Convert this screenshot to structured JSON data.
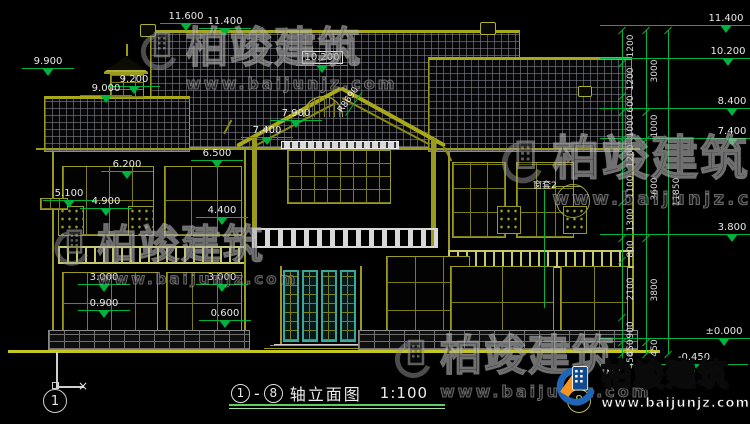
{
  "colors": {
    "line": "#9a9a20",
    "dimension": "#00b33c",
    "text": "#e8e8e8",
    "teal_door": "#3aa79b",
    "ground": "#c6c61e",
    "logo_blue": "#1f66b8",
    "logo_orange": "#f7941d"
  },
  "watermark": {
    "brand": "柏竣建筑",
    "url": "www.baijunjz.com"
  },
  "watermarks": {
    "instances": [
      {
        "x": 132,
        "y": 26,
        "scale": 1.0
      },
      {
        "x": 46,
        "y": 224,
        "scale": 0.95
      },
      {
        "x": 492,
        "y": 134,
        "scale": 1.12
      },
      {
        "x": 386,
        "y": 334,
        "scale": 1.0
      }
    ]
  },
  "logo": {
    "brand": "柏竣建筑",
    "url": "www.baijunjz.com"
  },
  "drawing": {
    "title": {
      "axis_from": "1",
      "dash": "-",
      "axis_to": "8",
      "name": "轴立面图",
      "scale": "1:100"
    },
    "axis_bubbles": [
      {
        "label": "1"
      },
      {
        "label": "8"
      }
    ],
    "ucs_x": "×",
    "slope_label": "R8690",
    "window_callout": "窗套2",
    "px_per_mm": 0.027368,
    "elevation_markers": [
      {
        "v": "9.900",
        "x": 22,
        "y": 56
      },
      {
        "v": "11.600",
        "x": 160,
        "y": 11
      },
      {
        "v": "11.400",
        "x": 199,
        "y": 16
      },
      {
        "v": "9.200",
        "x": 108,
        "y": 74
      },
      {
        "v": "9.000",
        "x": 80,
        "y": 83
      },
      {
        "v": "10.200",
        "x": 296,
        "y": 51,
        "boxed": true
      },
      {
        "v": "7.900",
        "x": 270,
        "y": 108
      },
      {
        "v": "7.400",
        "x": 241,
        "y": 125
      },
      {
        "v": "6.500",
        "x": 191,
        "y": 148
      },
      {
        "v": "6.200",
        "x": 101,
        "y": 159
      },
      {
        "v": "5.100",
        "x": 43,
        "y": 188
      },
      {
        "v": "4.900",
        "x": 80,
        "y": 196
      },
      {
        "v": "4.400",
        "x": 196,
        "y": 205
      },
      {
        "v": "3.000",
        "x": 78,
        "y": 272
      },
      {
        "v": "3.000",
        "x": 196,
        "y": 272
      },
      {
        "v": "0.900",
        "x": 78,
        "y": 298
      },
      {
        "v": "0.600",
        "x": 199,
        "y": 308
      },
      {
        "v": "11.400",
        "x": 700,
        "y": 13,
        "level_line": true
      },
      {
        "v": "10.200",
        "x": 702,
        "y": 46,
        "level_line": true
      },
      {
        "v": "8.400",
        "x": 706,
        "y": 96,
        "level_line": true
      },
      {
        "v": "7.400",
        "x": 706,
        "y": 126,
        "level_line": true
      },
      {
        "v": "3.800",
        "x": 706,
        "y": 222,
        "level_line": true
      },
      {
        "v": "±0.000",
        "x": 698,
        "y": 326,
        "level_line": true
      },
      {
        "v": "-0.450",
        "x": 668,
        "y": 352,
        "level_line": true
      }
    ],
    "dim_chains": [
      {
        "x": 622,
        "top": 30,
        "values": [
          1200,
          1200,
          600,
          1000,
          1200,
          1100,
          1300,
          800,
          2100,
          900,
          450,
          450
        ]
      },
      {
        "x": 646,
        "top": 30,
        "values": [
          3000,
          1000,
          3600,
          3800,
          450
        ]
      },
      {
        "x": 668,
        "top": 30,
        "values": [
          11850
        ]
      }
    ]
  }
}
